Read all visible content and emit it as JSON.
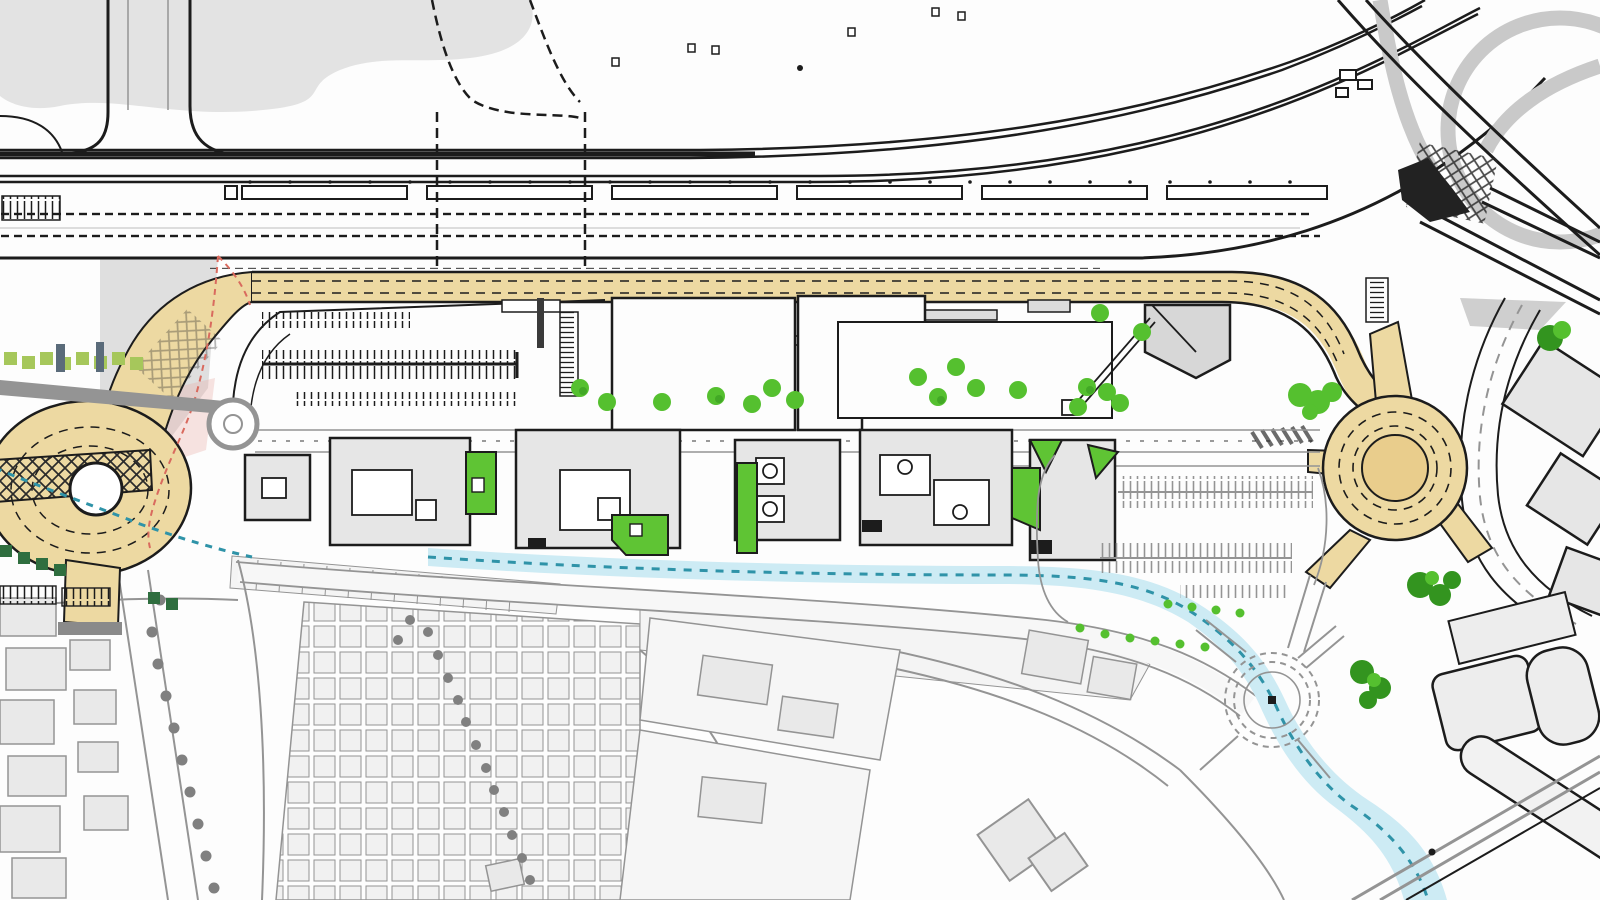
{
  "document": {
    "kind": "urban-masterplan-site-plan",
    "visible_text": "none"
  },
  "palette": {
    "paper": "#FDFDFD",
    "ink": "#1C1C1C",
    "gray_area": "#E3E3E3",
    "gray_fill": "#F1F1F1",
    "gray_build": "#EAEAEA",
    "gray_line": "#949494",
    "gray_dark": "#6A6A6A",
    "dev_fill": "#E6E6E6",
    "road_tan": "#EDD9A2",
    "road_tan_deep": "#E9CD8C",
    "green_bright": "#55C02F",
    "green_patch": "#5FC434",
    "green_dark": "#33941F",
    "green_olive": "#A6C75B",
    "stream_fill": "#CDEBF4",
    "stream_teal": "#2F93A8",
    "boundary_red": "#D96A5E",
    "slate": "#5A6B7A"
  },
  "features": [
    {
      "id": "railway-corridor",
      "label": "multi-track railway with sleepers and station platform"
    },
    {
      "id": "rail-interchange",
      "label": "rail and motorway interchange, top right"
    },
    {
      "id": "main-boulevard",
      "label": "new tan boulevard looping through the site"
    },
    {
      "id": "west-oval-roundabout",
      "label": "elongated western roundabout with cross-hatched bridge deck"
    },
    {
      "id": "east-roundabout",
      "label": "large circular eastern roundabout"
    },
    {
      "id": "local-roundabout",
      "label": "small service roundabout at site entrance"
    },
    {
      "id": "existing-roundabout",
      "label": "existing roundabout drawn in gray, lower right"
    },
    {
      "id": "stream-channel",
      "label": "stream / canal with teal dashed centreline"
    },
    {
      "id": "tree-plaza",
      "label": "formal tree grid plaza"
    },
    {
      "id": "parking-west",
      "label": "western surface parking rows"
    },
    {
      "id": "parking-east",
      "label": "eastern surface parking rows"
    },
    {
      "id": "development-buildings",
      "label": "proposed buildings, black outline with courtyards"
    },
    {
      "id": "existing-town",
      "label": "existing town fabric drawn in gray"
    },
    {
      "id": "site-boundary",
      "label": "red dashed site boundary"
    },
    {
      "id": "rail-yard-southeast",
      "label": "rail sidings and depot, bottom right"
    }
  ]
}
